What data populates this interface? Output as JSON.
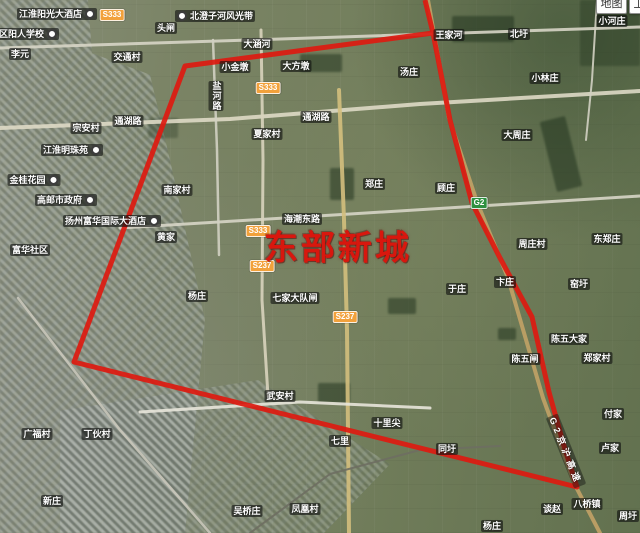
{
  "controls": {
    "map_button": "地图",
    "satellite_button": "卫星"
  },
  "overlay": {
    "title": "东部新城",
    "title_x": 338,
    "title_y": 245
  },
  "highway_label": {
    "text": "G2京沪高速",
    "x": 566,
    "y": 451,
    "angle": 68
  },
  "colors": {
    "boundary_red": "#dd1a10",
    "title_red": "#d8170e",
    "badge_provincial": "#f2a13b",
    "badge_expressway": "#2d9040"
  },
  "boundary_polygon": [
    [
      425,
      0
    ],
    [
      433,
      33
    ],
    [
      450,
      120
    ],
    [
      472,
      203
    ],
    [
      500,
      258
    ],
    [
      532,
      317
    ],
    [
      549,
      392
    ],
    [
      564,
      446
    ],
    [
      577,
      487
    ],
    [
      74,
      362
    ],
    [
      185,
      66
    ],
    [
      433,
      33
    ]
  ],
  "roads": [
    {
      "name": "",
      "points": [
        [
          0,
          48
        ],
        [
          250,
          40
        ],
        [
          640,
          27
        ]
      ],
      "color": "#d7d5c6",
      "width": 3
    },
    {
      "name": "通湖路",
      "points": [
        [
          0,
          128
        ],
        [
          230,
          119
        ],
        [
          420,
          104
        ],
        [
          640,
          91
        ]
      ],
      "color": "#ded9c5",
      "width": 4
    },
    {
      "name": "海潮东路",
      "points": [
        [
          120,
          228
        ],
        [
          350,
          214
        ],
        [
          640,
          196
        ]
      ],
      "color": "#d7d5c6",
      "width": 3
    },
    {
      "name": "",
      "points": [
        [
          213,
          40
        ],
        [
          217,
          150
        ],
        [
          219,
          255
        ]
      ],
      "color": "#d2d0c2",
      "width": 2.5
    },
    {
      "name": "S333",
      "points": [
        [
          261,
          30
        ],
        [
          263,
          160
        ],
        [
          262,
          300
        ],
        [
          268,
          396
        ]
      ],
      "color": "#d8d3bd",
      "width": 3
    },
    {
      "name": "",
      "points": [
        [
          339,
          90
        ],
        [
          344,
          220
        ],
        [
          347,
          330
        ],
        [
          349,
          533
        ]
      ],
      "color": "#d4bf7d",
      "width": 4
    },
    {
      "name": "G2京沪高速",
      "points": [
        [
          428,
          0
        ],
        [
          449,
          118
        ],
        [
          477,
          202
        ],
        [
          508,
          278
        ],
        [
          543,
          398
        ],
        [
          575,
          485
        ],
        [
          600,
          533
        ]
      ],
      "color": "#c2a266",
      "width": 4
    },
    {
      "name": "",
      "points": [
        [
          597,
          0
        ],
        [
          592,
          80
        ],
        [
          586,
          140
        ]
      ],
      "color": "#d2d0c2",
      "width": 2
    },
    {
      "name": "",
      "points": [
        [
          140,
          412
        ],
        [
          300,
          402
        ],
        [
          430,
          408
        ]
      ],
      "color": "#e8e6da",
      "width": 3
    },
    {
      "name": "",
      "points": [
        [
          18,
          298
        ],
        [
          120,
          430
        ],
        [
          210,
          533
        ]
      ],
      "color": "#c9c7ba",
      "width": 2.5
    },
    {
      "name": "",
      "points": [
        [
          250,
          533
        ],
        [
          330,
          474
        ],
        [
          420,
          450
        ],
        [
          500,
          446
        ]
      ],
      "color": "#6e6e62",
      "width": 2
    }
  ],
  "badges": [
    {
      "text": "S333",
      "x": 112,
      "y": 15,
      "kind": "provincial"
    },
    {
      "text": "S333",
      "x": 268,
      "y": 88,
      "kind": "provincial"
    },
    {
      "text": "S333",
      "x": 258,
      "y": 231,
      "kind": "provincial"
    },
    {
      "text": "S237",
      "x": 262,
      "y": 266,
      "kind": "provincial"
    },
    {
      "text": "S237",
      "x": 345,
      "y": 317,
      "kind": "provincial"
    },
    {
      "text": "G2",
      "x": 479,
      "y": 203,
      "kind": "expressway"
    }
  ],
  "labels": [
    {
      "text": "江淮阳光大酒店",
      "x": 57,
      "y": 14,
      "poi": true
    },
    {
      "text": "北澄子河风光带",
      "x": 215,
      "y": 16,
      "poi_left": true
    },
    {
      "text": "头闸",
      "x": 166,
      "y": 28
    },
    {
      "text": "区阳人学校",
      "x": 28,
      "y": 34,
      "poi": true
    },
    {
      "text": "李元",
      "x": 20,
      "y": 54
    },
    {
      "text": "交通村",
      "x": 127,
      "y": 57
    },
    {
      "text": "大涵河",
      "x": 257,
      "y": 44
    },
    {
      "text": "小金墩",
      "x": 235,
      "y": 67
    },
    {
      "text": "大方墩",
      "x": 296,
      "y": 66
    },
    {
      "text": "汤庄",
      "x": 409,
      "y": 72
    },
    {
      "text": "王家河",
      "x": 449,
      "y": 35
    },
    {
      "text": "北圩",
      "x": 519,
      "y": 34
    },
    {
      "text": "小河庄",
      "x": 612,
      "y": 21
    },
    {
      "text": "小林庄",
      "x": 545,
      "y": 78
    },
    {
      "text": "大周庄",
      "x": 517,
      "y": 135
    },
    {
      "text": "通湖路",
      "x": 128,
      "y": 121
    },
    {
      "text": "通湖路",
      "x": 316,
      "y": 117
    },
    {
      "text": "夏家村",
      "x": 267,
      "y": 134
    },
    {
      "text": "宗安村",
      "x": 86,
      "y": 128
    },
    {
      "text": "江淮明珠苑",
      "x": 72,
      "y": 150,
      "poi": true
    },
    {
      "text": "金桂花园",
      "x": 34,
      "y": 180,
      "poi": true
    },
    {
      "text": "南家村",
      "x": 177,
      "y": 190
    },
    {
      "text": "高邮市政府",
      "x": 66,
      "y": 200,
      "poi": true
    },
    {
      "text": "扬州富华国际大酒店",
      "x": 112,
      "y": 221,
      "poi": true
    },
    {
      "text": "黄家",
      "x": 166,
      "y": 237
    },
    {
      "text": "富华社区",
      "x": 30,
      "y": 250
    },
    {
      "text": "海潮东路",
      "x": 302,
      "y": 219
    },
    {
      "text": "郑庄",
      "x": 374,
      "y": 184
    },
    {
      "text": "顾庄",
      "x": 446,
      "y": 188
    },
    {
      "text": "周庄村",
      "x": 532,
      "y": 244
    },
    {
      "text": "东郑庄",
      "x": 607,
      "y": 239
    },
    {
      "text": "于庄",
      "x": 457,
      "y": 289
    },
    {
      "text": "卞庄",
      "x": 505,
      "y": 282
    },
    {
      "text": "窑圩",
      "x": 579,
      "y": 284
    },
    {
      "text": "杨庄",
      "x": 197,
      "y": 296
    },
    {
      "text": "七家大队闸",
      "x": 295,
      "y": 298
    },
    {
      "text": "陈五大家",
      "x": 569,
      "y": 339
    },
    {
      "text": "陈五闸",
      "x": 525,
      "y": 359
    },
    {
      "text": "郑家村",
      "x": 597,
      "y": 358
    },
    {
      "text": "武安村",
      "x": 280,
      "y": 396
    },
    {
      "text": "十里尖",
      "x": 387,
      "y": 423
    },
    {
      "text": "七里",
      "x": 340,
      "y": 441
    },
    {
      "text": "同圩",
      "x": 447,
      "y": 449
    },
    {
      "text": "付家",
      "x": 613,
      "y": 414
    },
    {
      "text": "卢家",
      "x": 610,
      "y": 448
    },
    {
      "text": "广福村",
      "x": 37,
      "y": 434
    },
    {
      "text": "丁伙村",
      "x": 97,
      "y": 434
    },
    {
      "text": "新庄",
      "x": 52,
      "y": 501
    },
    {
      "text": "吴桥庄",
      "x": 247,
      "y": 511
    },
    {
      "text": "凤凰村",
      "x": 305,
      "y": 509
    },
    {
      "text": "八桥镇",
      "x": 587,
      "y": 504
    },
    {
      "text": "谈赵",
      "x": 552,
      "y": 509
    },
    {
      "text": "杨庄",
      "x": 492,
      "y": 526
    },
    {
      "text": "周圩",
      "x": 628,
      "y": 516
    }
  ],
  "vertical_labels": [
    {
      "text": "盐河路",
      "x": 216,
      "y": 96
    }
  ]
}
